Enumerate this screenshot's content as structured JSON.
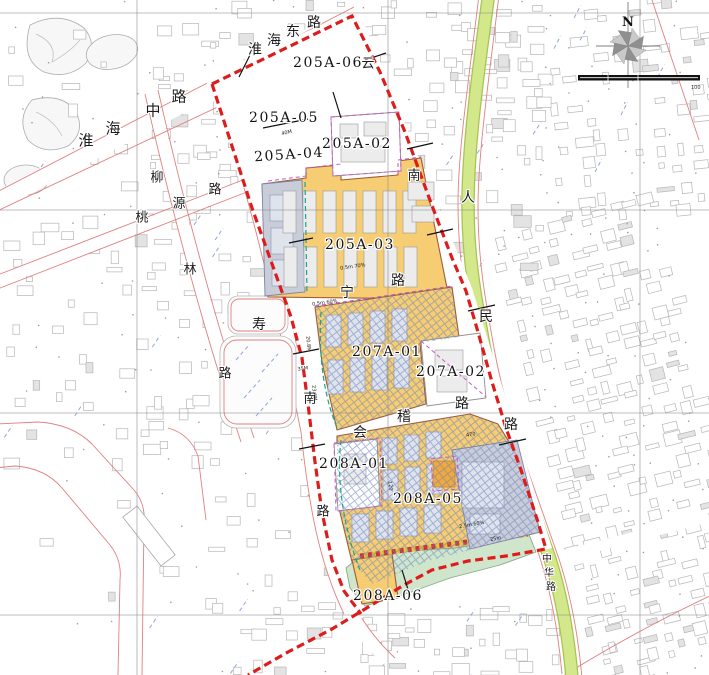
{
  "map": {
    "compass": {
      "north_label": "N"
    },
    "scale_bar": {
      "end_label": "100"
    },
    "parcel_labels": [
      {
        "id": "205A-06",
        "x": 328,
        "y": 62
      },
      {
        "id": "205A-05",
        "x": 284,
        "y": 117
      },
      {
        "id": "205A-04",
        "x": 289,
        "y": 154,
        "rot": -4
      },
      {
        "id": "205A-02",
        "x": 357,
        "y": 143
      },
      {
        "id": "205A-03",
        "x": 360,
        "y": 244
      },
      {
        "id": "207A-01",
        "x": 387,
        "y": 351
      },
      {
        "id": "207A-02",
        "x": 451,
        "y": 371
      },
      {
        "id": "208A-01",
        "x": 354,
        "y": 463
      },
      {
        "id": "208A-05",
        "x": 428,
        "y": 498
      },
      {
        "id": "208A-06",
        "x": 388,
        "y": 595
      }
    ],
    "street_names": [
      {
        "name": "淮海中路",
        "size": 15,
        "chars": [
          [
            "淮",
            86,
            139
          ],
          [
            "海",
            113,
            127
          ],
          [
            "中",
            153,
            109
          ],
          [
            "路",
            179,
            95
          ]
        ]
      },
      {
        "name": "淮海东路",
        "size": 14,
        "chars": [
          [
            "淮",
            255,
            48
          ],
          [
            "海",
            274,
            39
          ],
          [
            "东",
            293,
            30
          ],
          [
            "路",
            314,
            21
          ]
        ]
      },
      {
        "name": "桃源路",
        "size": 13,
        "chars": [
          [
            "桃",
            142,
            216
          ],
          [
            "源",
            179,
            202
          ],
          [
            "路",
            215,
            188
          ]
        ]
      },
      {
        "name": "柳林路",
        "size": 13,
        "chars": [
          [
            "柳",
            157,
            176
          ],
          [
            "林",
            190,
            268
          ],
          [
            "路",
            225,
            372
          ]
        ]
      },
      {
        "name": "寿宁路",
        "size": 14,
        "chars": [
          [
            "寿",
            259,
            323
          ],
          [
            "宁",
            347,
            291
          ],
          [
            "路",
            398,
            279
          ]
        ]
      },
      {
        "name": "会稽路",
        "size": 14,
        "chars": [
          [
            "会",
            360,
            431
          ],
          [
            "稽",
            404,
            415
          ],
          [
            "路",
            462,
            402
          ]
        ]
      },
      {
        "name": "人民路",
        "size": 14,
        "chars": [
          [
            "人",
            468,
            196
          ],
          [
            "民",
            486,
            315
          ],
          [
            "路",
            511,
            423
          ]
        ]
      },
      {
        "name": "中华路",
        "size": 10,
        "chars": [
          [
            "中",
            547,
            558
          ],
          [
            "华",
            549,
            572
          ],
          [
            "路",
            551,
            586
          ]
        ]
      },
      {
        "name": "云南南路",
        "size": 13,
        "chars": [
          [
            "云",
            368,
            62
          ],
          [
            "南",
            414,
            174
          ]
        ]
      },
      {
        "name": "南路",
        "size": 13,
        "chars": [
          [
            "南",
            310,
            397
          ],
          [
            "路",
            323,
            510
          ]
        ]
      }
    ],
    "annotations": [
      [
        "40M",
        287,
        134,
        -14
      ],
      [
        "35M",
        303,
        370,
        -8
      ],
      [
        "470",
        471,
        436,
        -8
      ],
      [
        "120",
        389,
        486,
        82
      ],
      [
        "25m",
        496,
        540,
        -12
      ],
      [
        "2.5m 60%",
        472,
        526,
        -10
      ],
      [
        "0.5m 70%",
        353,
        268,
        -8
      ],
      [
        "0.5m 60%",
        325,
        304,
        -8
      ],
      [
        "23.4M",
        313,
        393,
        84
      ],
      [
        "20.8M",
        307,
        344,
        84
      ]
    ],
    "colors": {
      "boundary": "#dd1c1c",
      "parcel_yellow": "#f6cd72",
      "parcel_gray_blue": "#c9cdd9",
      "road_green": "#d3e88b",
      "road_green_edge": "#aac254",
      "area_green": "#cfe6cc",
      "accent_orange": "#f2a93b",
      "hatch_blue": "#6f86bf",
      "dash_magenta": "#c75ac7",
      "dash_teal": "#15a78f",
      "road_edge_red": "#e08080"
    }
  }
}
